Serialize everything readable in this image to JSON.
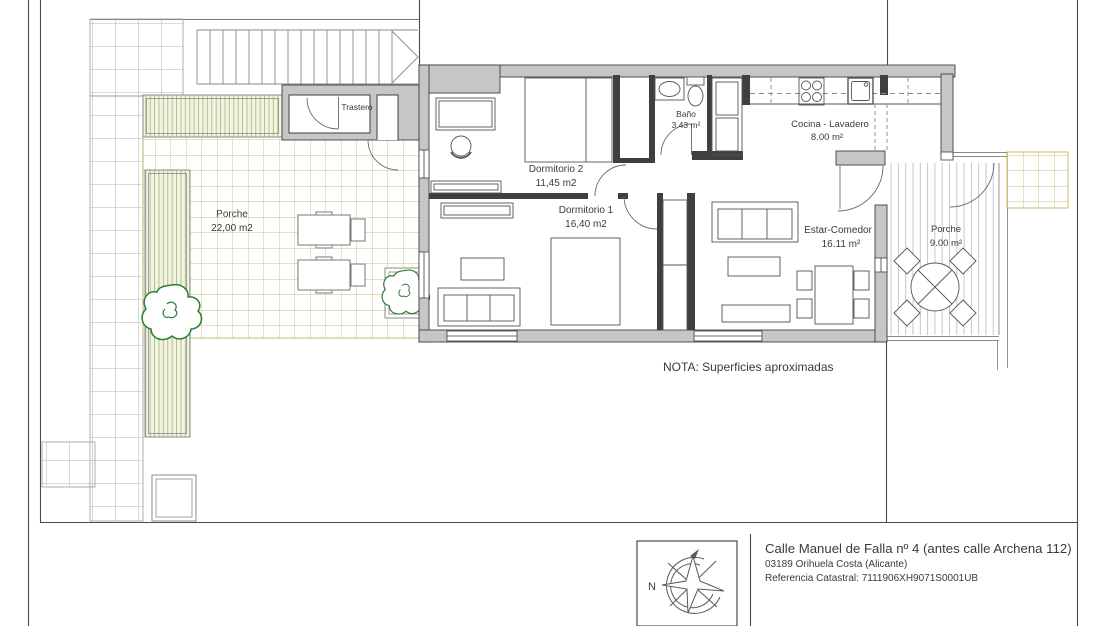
{
  "plan": {
    "note": "NOTA: Superficies aproximadas",
    "rooms": {
      "trastero": {
        "label": "Trastero"
      },
      "dormitorio2": {
        "label": "Dormitorio 2",
        "area": "11,45 m2"
      },
      "dormitorio1": {
        "label": "Dormitorio 1",
        "area": "16,40 m2"
      },
      "bano": {
        "label": "Baño",
        "area": "3.43 m²"
      },
      "cocina": {
        "label": "Cocina - Lavadero",
        "area": "8.00 m²"
      },
      "estar": {
        "label": "Estar-Comedor",
        "area": "16.11 m²"
      },
      "porche_oeste": {
        "label": "Porche",
        "area": "22,00 m2"
      },
      "porche_este": {
        "label": "Porche",
        "area": "9.00 m²"
      }
    }
  },
  "title_block": {
    "compass_north_label": "N",
    "address_line1": "Calle Manuel de Falla nº 4 (antes calle Archena 112)",
    "address_line2": "03189 Orihuela Costa (Alicante)",
    "address_line3": "Referencia Catastral: 7111906XH9071S0001UB"
  },
  "colors": {
    "wall_fill": "#c6c6c6",
    "wall_outline": "#3f3f3f",
    "interior_wall": "#3f3f3f",
    "tile_grid_line": "#cdbf74",
    "paving_grid_line": "#9c9c9c",
    "planter_fill": "#f1f4e0",
    "planter_stripe": "#a9b27b",
    "decking_line": "#b9b9b9",
    "tree_stroke": "#2f7d32",
    "text": "#3a3a3a"
  }
}
